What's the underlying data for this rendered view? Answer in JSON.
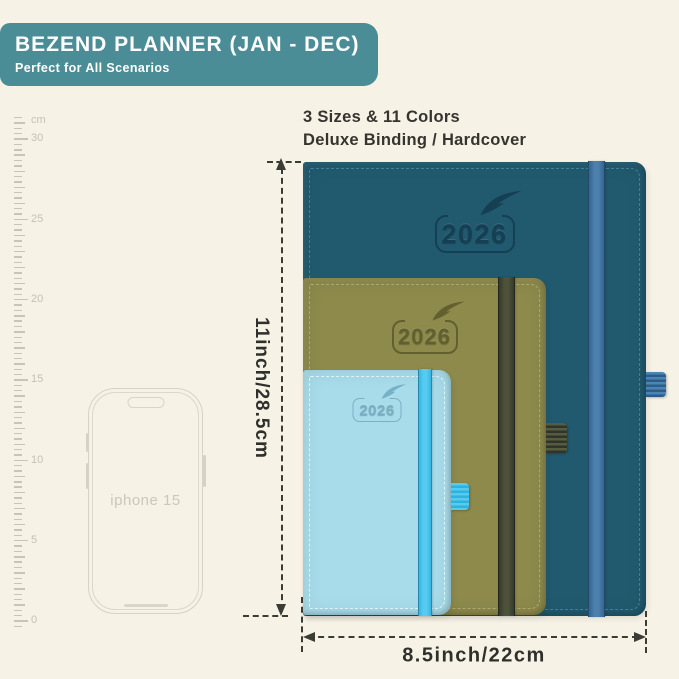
{
  "canvas": {
    "bg": "#f6f2e6"
  },
  "banner": {
    "title": "BEZEND PLANNER (JAN - DEC)",
    "subtitle": "Perfect for All Scenarios",
    "bg": "#4b8d96",
    "text_color": "#ffffff"
  },
  "info": {
    "line1": "3 Sizes & 11 Colors",
    "line2": "Deluxe Binding / Hardcover"
  },
  "ruler": {
    "unit": "cm",
    "labels": [
      "30",
      "25",
      "20",
      "15",
      "10",
      "5",
      "0"
    ],
    "color": "#c9c4b6"
  },
  "phone": {
    "label": "iphone 15",
    "line_color": "#d6d2c5"
  },
  "planners": [
    {
      "id": "large",
      "year": "2026",
      "colors": {
        "cover": "#215a6e",
        "stitch": "#4c85a0",
        "elastic": "#4c80ad",
        "elastic_dark": "#2f608c",
        "logo": "#153f52",
        "loop": "#4c84b2",
        "loop_dark": "#2c5c88"
      }
    },
    {
      "id": "medium",
      "year": "2026",
      "colors": {
        "cover": "#8d8a4c",
        "stitch": "#b4af74",
        "elastic": "#4d5239",
        "elastic_dark": "#30342a",
        "logo": "#62602f",
        "loop": "#565c3e",
        "loop_dark": "#30342a"
      }
    },
    {
      "id": "small",
      "year": "2026",
      "colors": {
        "cover": "#a8dcea",
        "stitch": "#e9f7fb",
        "elastic": "#55cbf2",
        "elastic_dark": "#2fb2e0",
        "logo": "#77b1c7",
        "loop": "#55cbf0",
        "loop_dark": "#2fb2dd"
      }
    }
  ],
  "dimensions": {
    "height_label": "11inch/28.5cm",
    "width_label": "8.5inch/22cm",
    "line_color": "#3c3c37"
  }
}
